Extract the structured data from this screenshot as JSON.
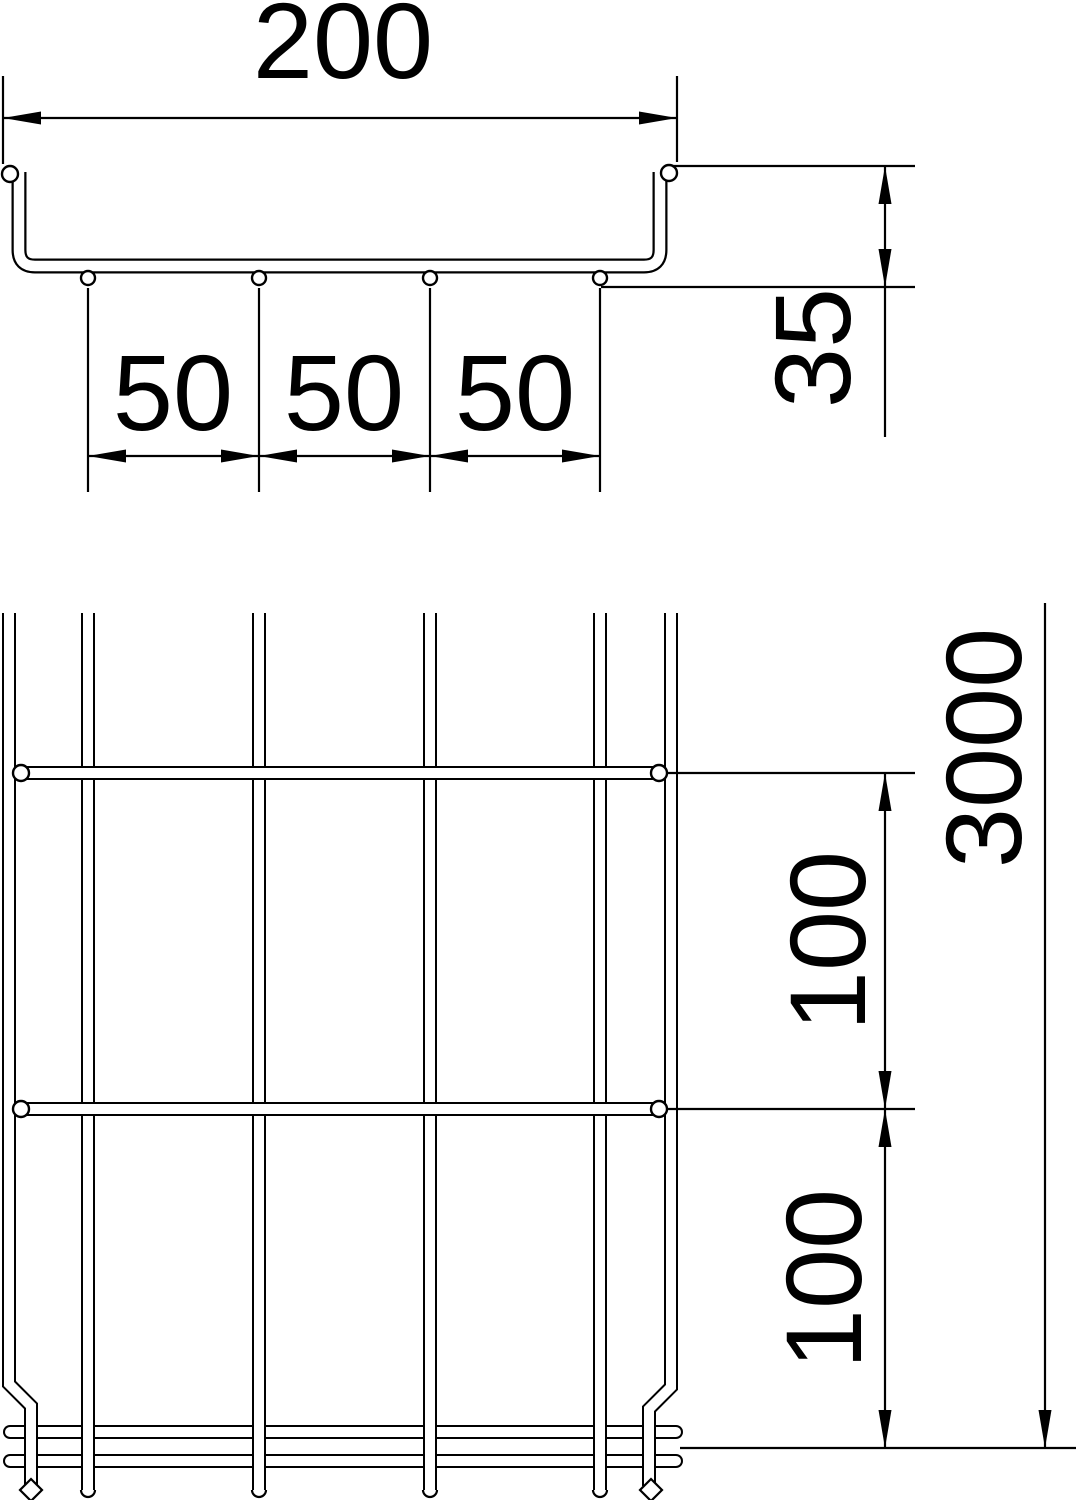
{
  "drawing": {
    "type": "technical-dimension-drawing",
    "subject": "wire-mesh-cable-tray",
    "colors": {
      "line": "#000000",
      "background": "#ffffff"
    },
    "cross_section": {
      "width_label": "200",
      "spacing_labels": [
        "50",
        "50",
        "50"
      ],
      "height_label": "35"
    },
    "plan_view": {
      "length_label": "3000",
      "pitch_labels": [
        "100",
        "100"
      ]
    }
  }
}
